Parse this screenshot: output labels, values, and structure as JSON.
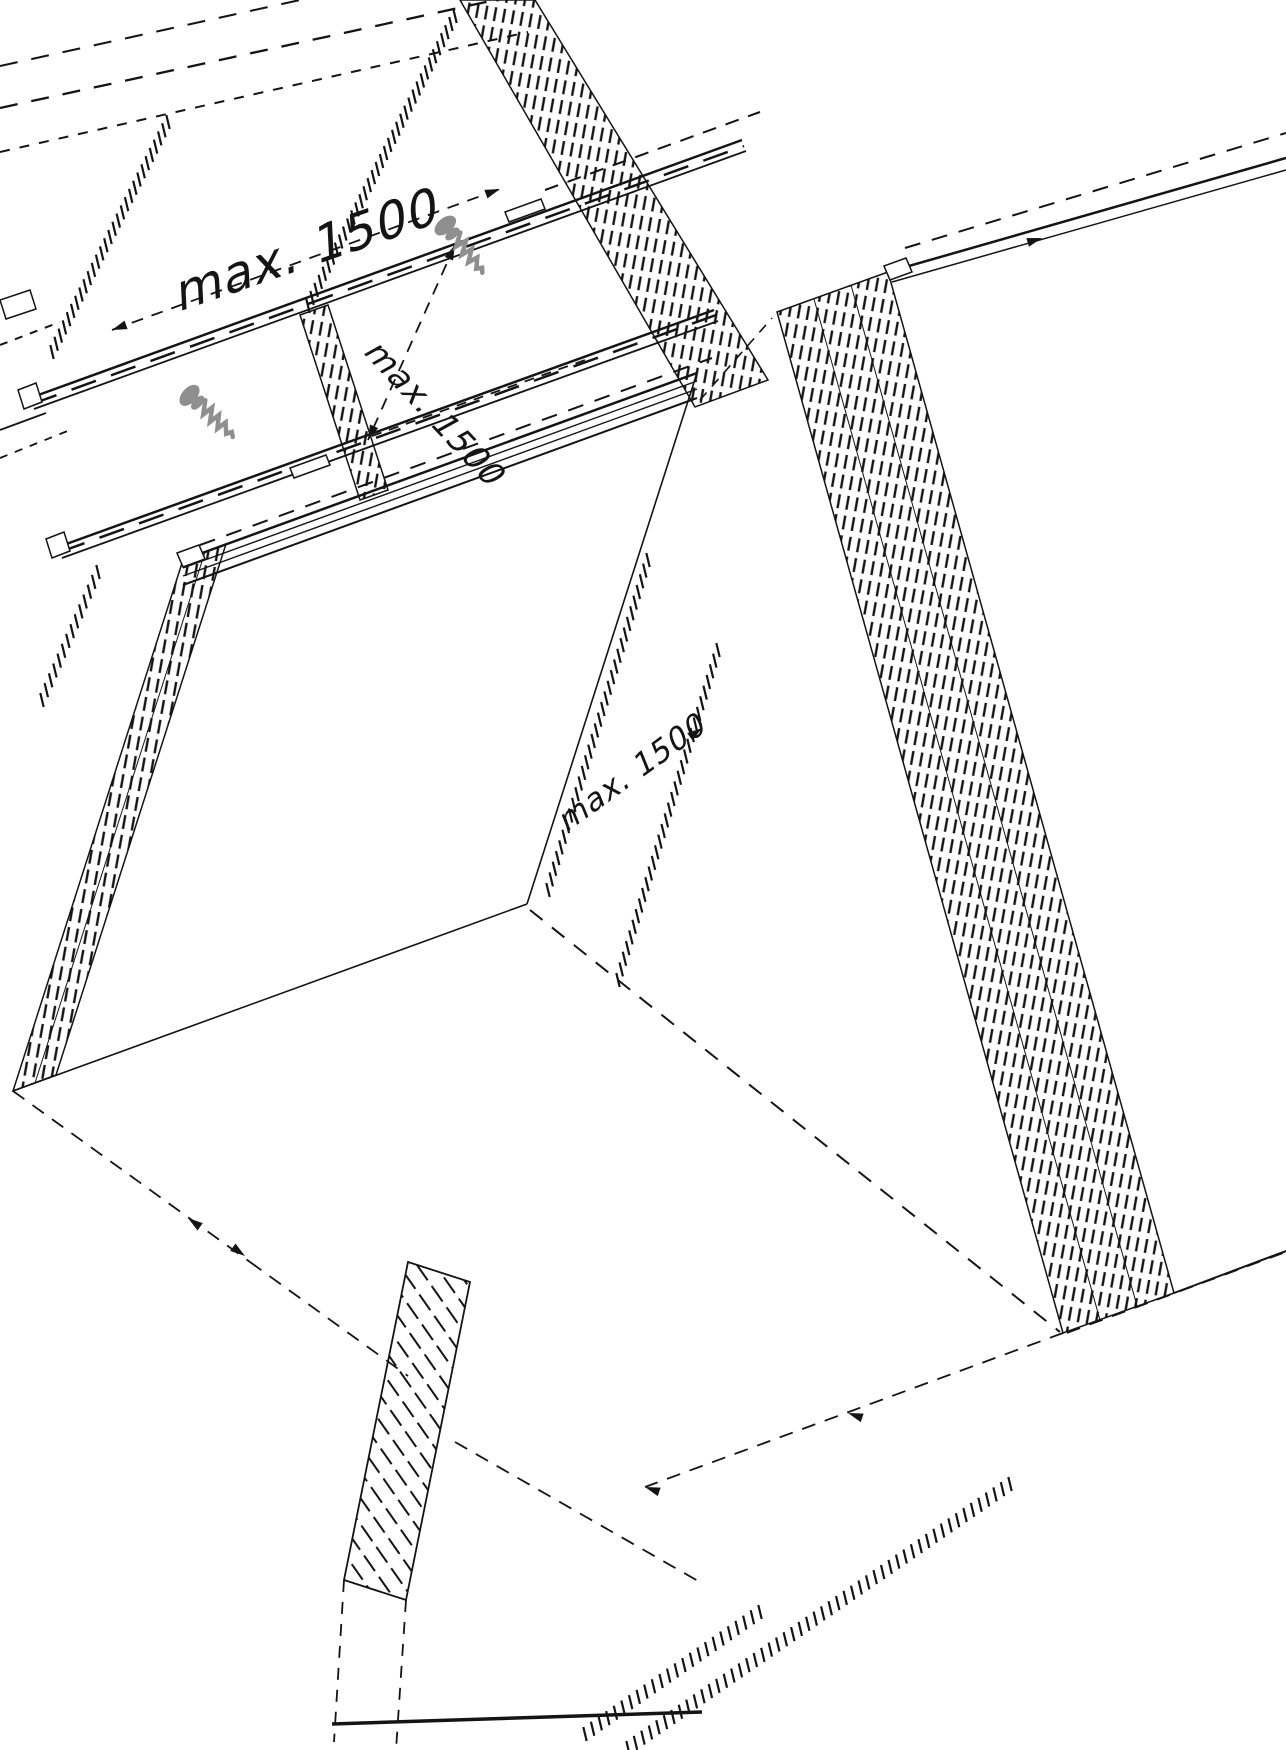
{
  "drawing": {
    "type": "isometric-assembly-diagram",
    "background": "#ffffff",
    "line_color": "#141414",
    "hardware_color": "#8f8f8f",
    "labels": {
      "dim_rail_spacing_top": "max. 1500",
      "dim_rafter_spacing": "max. 1500",
      "dim_module_field": "max. 1500"
    },
    "icons": [
      "screw-icon",
      "screw-icon"
    ]
  }
}
